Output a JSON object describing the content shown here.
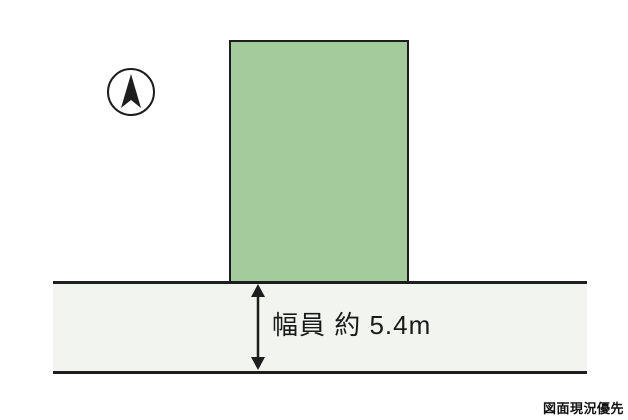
{
  "diagram": {
    "road_width_label": "幅員 約 5.4m",
    "footer_note": "図面現況優先",
    "colors": {
      "parcel_fill": "#a3cb9b",
      "road_fill": "#f2f5ef",
      "line": "#1e1e1e",
      "background": "#ffffff"
    },
    "icons": {
      "north_arrow": "north-arrow-in-circle",
      "dimension_arrow": "vertical-double-headed-arrow"
    }
  }
}
